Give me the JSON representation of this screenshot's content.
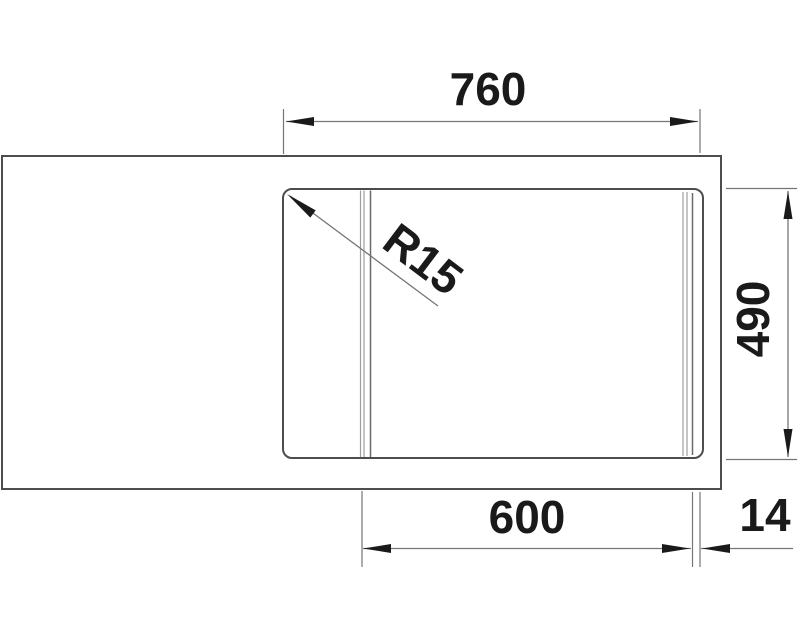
{
  "drawing": {
    "type": "sink-technical-dimension-drawing",
    "view": "top",
    "labels": {
      "top_width": "760",
      "bowl_depth": "490",
      "bowl_width": "600",
      "edge_offset": "14",
      "corner_radius": "R15"
    },
    "dimensions_mm": {
      "top_width": 760,
      "bowl_depth": 490,
      "bowl_width": 600,
      "edge_offset": 14,
      "corner_radius": 15
    },
    "colors": {
      "outline": "#4d4d4d",
      "dimension_lines": "#757575",
      "annotation_text": "#1a1a1a",
      "background": "#ffffff"
    }
  }
}
